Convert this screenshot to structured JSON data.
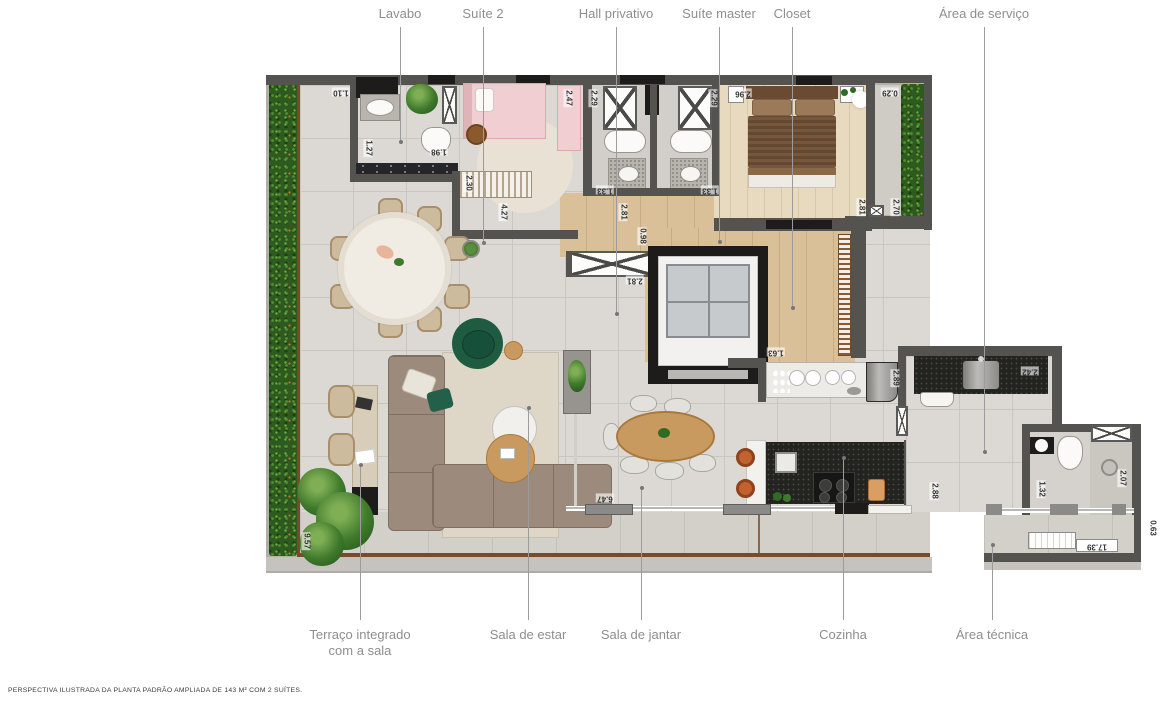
{
  "disclaimer": "PERSPECTIVA ILUSTRADA DA PLANTA PADRÃO AMPLIADA DE 143 M² COM 2 SUÍTES.",
  "colors": {
    "wall": "#55534f",
    "wall_black": "#1d1c1a",
    "tile": "#dcd9d4",
    "tile_dark": "#d3d0ca",
    "wood": "#d9c098",
    "wood_light": "#e8dabf",
    "hedge_base": "#2e5a1f",
    "label": "#8e8e8e",
    "measure": "#333333",
    "leader": "#9c9c9c",
    "sofa": "#9c8b7c",
    "bed_master": "#74573c",
    "bed_suite2": "#f0ced2",
    "green_accent": "#1e5b40",
    "counter_black": "#232320",
    "stool_orange": "#c2632f",
    "table_wood": "#c99a60",
    "rug": "#ded7c8",
    "beige": "#d8cdb8",
    "marble": "#f0ebe3",
    "terrace_border": "#7a4a2a",
    "ledge": "#c6c3be",
    "planter": "#b2afa8"
  },
  "callouts": {
    "top": [
      {
        "label": "Lavabo",
        "x": 400,
        "line_to": 142
      },
      {
        "label": "Suíte 2",
        "x": 483,
        "line_to": 243
      },
      {
        "label": "Hall privativo",
        "x": 616,
        "line_to": 314
      },
      {
        "label": "Suíte master",
        "x": 719,
        "line_to": 242
      },
      {
        "label": "Closet",
        "x": 792,
        "line_to": 308
      },
      {
        "label": "Área de serviço",
        "x": 984,
        "line_to": 452
      }
    ],
    "bottom": [
      {
        "label": "Terraço integrado\ncom a sala",
        "x": 360,
        "line_from": 465
      },
      {
        "label": "Sala de estar",
        "x": 528,
        "line_from": 408
      },
      {
        "label": "Sala de jantar",
        "x": 641,
        "line_from": 488
      },
      {
        "label": "Cozinha",
        "x": 843,
        "line_from": 458
      },
      {
        "label": "Área técnica",
        "x": 992,
        "line_from": 545
      }
    ]
  },
  "measurements": [
    {
      "v": "1.10",
      "x": 341,
      "y": 92,
      "r": 180
    },
    {
      "v": "1.27",
      "x": 368,
      "y": 148,
      "r": 90
    },
    {
      "v": "1.98",
      "x": 439,
      "y": 151,
      "r": 180
    },
    {
      "v": "2.30",
      "x": 468,
      "y": 183,
      "r": 90
    },
    {
      "v": "4.27",
      "x": 503,
      "y": 212,
      "r": 90
    },
    {
      "v": "2.47",
      "x": 568,
      "y": 98,
      "r": 90
    },
    {
      "v": "2.29",
      "x": 593,
      "y": 98,
      "r": 90
    },
    {
      "v": "2.29",
      "x": 713,
      "y": 98,
      "r": 90
    },
    {
      "v": "2.96",
      "x": 743,
      "y": 93,
      "r": 180
    },
    {
      "v": "0.29",
      "x": 890,
      "y": 92,
      "r": 180
    },
    {
      "v": "1.33",
      "x": 605,
      "y": 190,
      "r": 180
    },
    {
      "v": "1.33",
      "x": 710,
      "y": 190,
      "r": 180
    },
    {
      "v": "2.81",
      "x": 623,
      "y": 212,
      "r": 90
    },
    {
      "v": "0.98",
      "x": 642,
      "y": 236,
      "r": 90
    },
    {
      "v": "2.81",
      "x": 635,
      "y": 280,
      "r": 180
    },
    {
      "v": "2.81",
      "x": 861,
      "y": 207,
      "r": 90
    },
    {
      "v": "2.70",
      "x": 895,
      "y": 207,
      "r": 90
    },
    {
      "v": "1.63",
      "x": 776,
      "y": 352,
      "r": 180
    },
    {
      "v": "2.89",
      "x": 895,
      "y": 378,
      "r": 90
    },
    {
      "v": "2.42",
      "x": 1030,
      "y": 371,
      "r": 180
    },
    {
      "v": "2.88",
      "x": 934,
      "y": 491,
      "r": 90
    },
    {
      "v": "1.32",
      "x": 1041,
      "y": 489,
      "r": 90
    },
    {
      "v": "2.07",
      "x": 1122,
      "y": 478,
      "r": 90
    },
    {
      "v": "0.63",
      "x": 1152,
      "y": 528,
      "r": 90
    },
    {
      "v": "17.39",
      "x": 1097,
      "y": 546,
      "r": 180
    },
    {
      "v": "9.57",
      "x": 306,
      "y": 541,
      "r": 90
    },
    {
      "v": "6.47",
      "x": 605,
      "y": 498,
      "r": 180
    }
  ]
}
